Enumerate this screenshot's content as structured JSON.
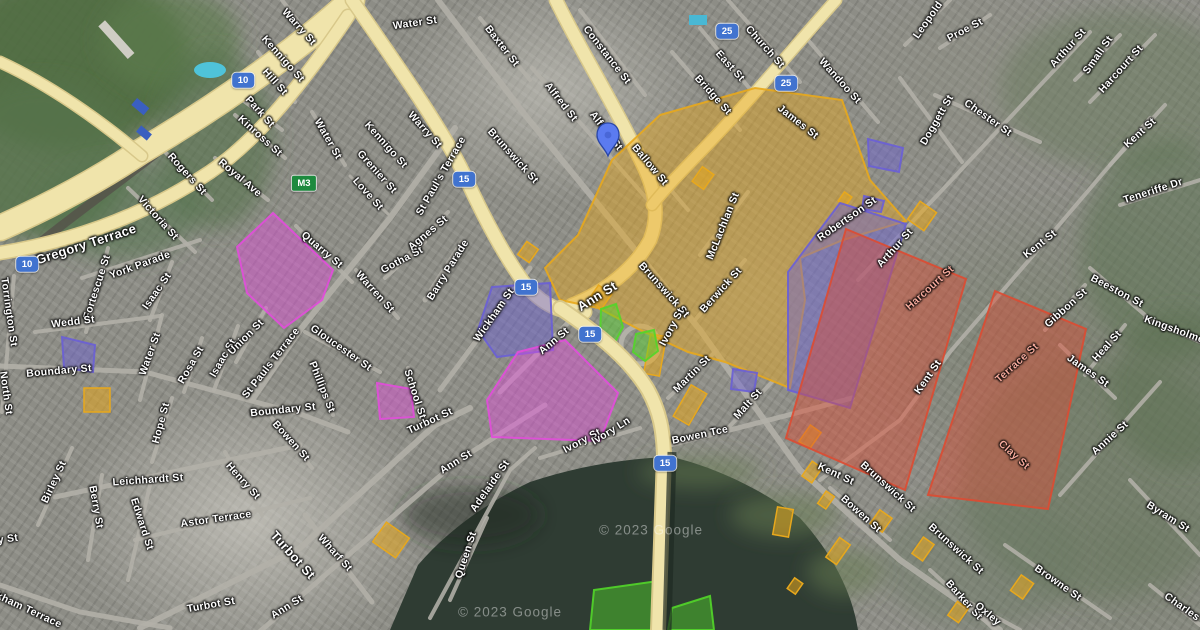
{
  "colors": {
    "zone_magenta": "#E24DDB",
    "zone_purple": "#6A5FD6",
    "zone_orange": "#E8A81C",
    "zone_red": "#DD4B32",
    "zone_green": "#52D629",
    "road_yellow": "#F0E4AB",
    "road_yellow_casing": "#D8C88A",
    "road_gray": "#B3B1A8",
    "water": "#2F3C33",
    "pin_blue": "#5B7BF0",
    "shield_blue": "#4173CF",
    "shield_green": "#1D8A3E"
  },
  "map": {
    "attribution": "© 2023 Google",
    "pin": {
      "x": 608,
      "y": 158
    },
    "shields": [
      {
        "label": "M3",
        "x": 304,
        "y": 183,
        "kind": "green"
      },
      {
        "label": "10",
        "x": 243,
        "y": 80,
        "kind": "blue"
      },
      {
        "label": "10",
        "x": 27,
        "y": 264,
        "kind": "blue"
      },
      {
        "label": "15",
        "x": 464,
        "y": 179,
        "kind": "blue"
      },
      {
        "label": "15",
        "x": 526,
        "y": 287,
        "kind": "blue"
      },
      {
        "label": "15",
        "x": 590,
        "y": 334,
        "kind": "blue"
      },
      {
        "label": "15",
        "x": 665,
        "y": 463,
        "kind": "blue"
      },
      {
        "label": "25",
        "x": 727,
        "y": 31,
        "kind": "blue"
      },
      {
        "label": "25",
        "x": 786,
        "y": 83,
        "kind": "blue"
      }
    ],
    "labels": [
      {
        "t": "Warry St",
        "x": 299,
        "y": 27,
        "r": 48
      },
      {
        "t": "Kennigo St",
        "x": 283,
        "y": 59,
        "r": 48
      },
      {
        "t": "Hill St",
        "x": 275,
        "y": 82,
        "r": 48
      },
      {
        "t": "Park St",
        "x": 260,
        "y": 112,
        "r": 48
      },
      {
        "t": "Kinross St",
        "x": 260,
        "y": 136,
        "r": 42
      },
      {
        "t": "Water St",
        "x": 328,
        "y": 139,
        "r": 60
      },
      {
        "t": "Rogers St",
        "x": 187,
        "y": 174,
        "r": 48
      },
      {
        "t": "Royal Ave",
        "x": 240,
        "y": 178,
        "r": 40
      },
      {
        "t": "Victoria St",
        "x": 158,
        "y": 218,
        "r": 48
      },
      {
        "t": "Gregory Terrace",
        "x": 86,
        "y": 244,
        "r": -18,
        "c": "lg"
      },
      {
        "t": "York Parade",
        "x": 140,
        "y": 265,
        "r": -20
      },
      {
        "t": "Fortescue St",
        "x": 97,
        "y": 287,
        "r": -72
      },
      {
        "t": "Isaac St",
        "x": 157,
        "y": 291,
        "r": -55
      },
      {
        "t": "Wedd St",
        "x": 73,
        "y": 322,
        "r": -7
      },
      {
        "t": "Torrington St",
        "x": 9,
        "y": 312,
        "r": 82
      },
      {
        "t": "North St",
        "x": 6,
        "y": 393,
        "r": 82
      },
      {
        "t": "Boundary St",
        "x": 59,
        "y": 371,
        "r": -5
      },
      {
        "t": "Water St",
        "x": 150,
        "y": 354,
        "r": -70
      },
      {
        "t": "Rosa St",
        "x": 191,
        "y": 365,
        "r": -60
      },
      {
        "t": "Isaac St",
        "x": 223,
        "y": 358,
        "r": -60
      },
      {
        "t": "Union St",
        "x": 246,
        "y": 337,
        "r": -45
      },
      {
        "t": "St Pauls Terrace",
        "x": 271,
        "y": 363,
        "r": -52
      },
      {
        "t": "Quarry St",
        "x": 322,
        "y": 250,
        "r": 40
      },
      {
        "t": "Warren St",
        "x": 375,
        "y": 292,
        "r": 48
      },
      {
        "t": "Gloucester St",
        "x": 341,
        "y": 348,
        "r": 35
      },
      {
        "t": "Phillips St",
        "x": 322,
        "y": 387,
        "r": 68
      },
      {
        "t": "Boundary St",
        "x": 283,
        "y": 410,
        "r": -6
      },
      {
        "t": "School St",
        "x": 415,
        "y": 394,
        "r": 72
      },
      {
        "t": "Kennigo St",
        "x": 386,
        "y": 145,
        "r": 48
      },
      {
        "t": "Grenier St",
        "x": 377,
        "y": 172,
        "r": 48
      },
      {
        "t": "Love St",
        "x": 368,
        "y": 194,
        "r": 48
      },
      {
        "t": "Warry St",
        "x": 425,
        "y": 130,
        "r": 48
      },
      {
        "t": "St Paul's Terrace",
        "x": 441,
        "y": 176,
        "r": -60
      },
      {
        "t": "Water St",
        "x": 415,
        "y": 23,
        "r": -8
      },
      {
        "t": "Baxter St",
        "x": 502,
        "y": 46,
        "r": 52
      },
      {
        "t": "Constance St",
        "x": 607,
        "y": 55,
        "r": 52
      },
      {
        "t": "Alfred St",
        "x": 561,
        "y": 102,
        "r": 52
      },
      {
        "t": "Alfred St",
        "x": 606,
        "y": 131,
        "r": 52
      },
      {
        "t": "Ballow St",
        "x": 650,
        "y": 165,
        "r": 50
      },
      {
        "t": "East St",
        "x": 730,
        "y": 66,
        "r": 48
      },
      {
        "t": "Bridge St",
        "x": 713,
        "y": 95,
        "r": 48
      },
      {
        "t": "Church St",
        "x": 765,
        "y": 47,
        "r": 48
      },
      {
        "t": "Wandoo St",
        "x": 840,
        "y": 81,
        "r": 48
      },
      {
        "t": "James St",
        "x": 798,
        "y": 122,
        "r": 38
      },
      {
        "t": "Leopold",
        "x": 928,
        "y": 20,
        "r": -55
      },
      {
        "t": "Proe St",
        "x": 965,
        "y": 30,
        "r": -28
      },
      {
        "t": "Arthur St",
        "x": 1068,
        "y": 48,
        "r": -48
      },
      {
        "t": "Small St",
        "x": 1098,
        "y": 55,
        "r": -55
      },
      {
        "t": "Harcourt St",
        "x": 1121,
        "y": 69,
        "r": -48
      },
      {
        "t": "Chester St",
        "x": 988,
        "y": 118,
        "r": 35
      },
      {
        "t": "Doggett St",
        "x": 937,
        "y": 120,
        "r": -60
      },
      {
        "t": "Kent St",
        "x": 1140,
        "y": 133,
        "r": -42
      },
      {
        "t": "Teneriffe Dr",
        "x": 1153,
        "y": 191,
        "r": -18
      },
      {
        "t": "Gotha St",
        "x": 402,
        "y": 260,
        "r": -28
      },
      {
        "t": "Agnes St",
        "x": 428,
        "y": 233,
        "r": -40
      },
      {
        "t": "Barry Parade",
        "x": 448,
        "y": 270,
        "r": -58
      },
      {
        "t": "Wickham St",
        "x": 494,
        "y": 315,
        "r": -55
      },
      {
        "t": "Ann St",
        "x": 554,
        "y": 341,
        "r": -40
      },
      {
        "t": "Ann St",
        "x": 597,
        "y": 296,
        "r": -32,
        "c": "lg"
      },
      {
        "t": "Brunswick St",
        "x": 513,
        "y": 156,
        "r": 48
      },
      {
        "t": "Brunswick St",
        "x": 664,
        "y": 290,
        "r": 48
      },
      {
        "t": "McLachlan St",
        "x": 723,
        "y": 226,
        "r": -68
      },
      {
        "t": "Berwick St",
        "x": 721,
        "y": 290,
        "r": -48
      },
      {
        "t": "Ivory St",
        "x": 672,
        "y": 327,
        "r": -62
      },
      {
        "t": "Martin St",
        "x": 692,
        "y": 374,
        "r": -45
      },
      {
        "t": "Malt St",
        "x": 748,
        "y": 404,
        "r": -48
      },
      {
        "t": "Ivory St",
        "x": 582,
        "y": 441,
        "r": -28
      },
      {
        "t": "Ivory Ln",
        "x": 611,
        "y": 431,
        "r": -32
      },
      {
        "t": "Bowen Tce",
        "x": 700,
        "y": 435,
        "r": -12
      },
      {
        "t": "Robertson St",
        "x": 847,
        "y": 219,
        "r": -35
      },
      {
        "t": "Arthur St",
        "x": 895,
        "y": 248,
        "r": -48
      },
      {
        "t": "Harcourt St",
        "x": 930,
        "y": 288,
        "r": -42,
        "c": "red"
      },
      {
        "t": "Terrace St",
        "x": 1017,
        "y": 363,
        "r": -42,
        "c": "red"
      },
      {
        "t": "Kent St",
        "x": 928,
        "y": 377,
        "r": -55
      },
      {
        "t": "Kent St",
        "x": 1040,
        "y": 244,
        "r": -38
      },
      {
        "t": "Gibbon St",
        "x": 1066,
        "y": 308,
        "r": -42
      },
      {
        "t": "Beeston St",
        "x": 1117,
        "y": 291,
        "r": 28
      },
      {
        "t": "Kingsholme St",
        "x": 1181,
        "y": 332,
        "r": 20
      },
      {
        "t": "Heal St",
        "x": 1107,
        "y": 346,
        "r": -48
      },
      {
        "t": "James St",
        "x": 1088,
        "y": 371,
        "r": 35
      },
      {
        "t": "Kent St",
        "x": 836,
        "y": 474,
        "r": 25
      },
      {
        "t": "Brunswick St",
        "x": 888,
        "y": 487,
        "r": 42
      },
      {
        "t": "Brunswick St",
        "x": 956,
        "y": 549,
        "r": 42
      },
      {
        "t": "Bowen St",
        "x": 861,
        "y": 514,
        "r": 42
      },
      {
        "t": "Barker St",
        "x": 964,
        "y": 600,
        "r": 48
      },
      {
        "t": "Oxley",
        "x": 988,
        "y": 614,
        "r": 40
      },
      {
        "t": "Browne St",
        "x": 1058,
        "y": 583,
        "r": 35
      },
      {
        "t": "Annie St",
        "x": 1110,
        "y": 438,
        "r": -42
      },
      {
        "t": "Byram St",
        "x": 1168,
        "y": 517,
        "r": 32
      },
      {
        "t": "Charles",
        "x": 1182,
        "y": 607,
        "r": 35
      },
      {
        "t": "Clay St",
        "x": 1014,
        "y": 455,
        "r": 42,
        "c": "red"
      },
      {
        "t": "Turbot St",
        "x": 430,
        "y": 421,
        "r": -25
      },
      {
        "t": "Turbot St",
        "x": 293,
        "y": 555,
        "r": 48,
        "c": "lg"
      },
      {
        "t": "Turbot St",
        "x": 211,
        "y": 605,
        "r": -10
      },
      {
        "t": "Astor Terrace",
        "x": 216,
        "y": 519,
        "r": -8
      },
      {
        "t": "Leichhardt St",
        "x": 148,
        "y": 480,
        "r": -4
      },
      {
        "t": "Henry St",
        "x": 243,
        "y": 481,
        "r": 48
      },
      {
        "t": "Edward St",
        "x": 142,
        "y": 524,
        "r": 72
      },
      {
        "t": "Berry St",
        "x": 96,
        "y": 507,
        "r": 80
      },
      {
        "t": "Birley St",
        "x": 54,
        "y": 482,
        "r": -65
      },
      {
        "t": "Hope St",
        "x": 161,
        "y": 423,
        "r": -75
      },
      {
        "t": "Bowen St",
        "x": 291,
        "y": 441,
        "r": 48
      },
      {
        "t": "Wharf St",
        "x": 335,
        "y": 553,
        "r": 48
      },
      {
        "t": "Ann St",
        "x": 456,
        "y": 462,
        "r": -32
      },
      {
        "t": "Adelaide St",
        "x": 490,
        "y": 486,
        "r": -55
      },
      {
        "t": "Queen St",
        "x": 466,
        "y": 555,
        "r": -72
      },
      {
        "t": "Ann St",
        "x": 287,
        "y": 607,
        "r": -32
      },
      {
        "t": "Wickham Terrace",
        "x": 20,
        "y": 606,
        "r": 25
      },
      {
        "t": "y St",
        "x": 8,
        "y": 539,
        "r": -8
      },
      {
        "t": "© 2023 Google",
        "x": 651,
        "y": 530,
        "r": 0,
        "c": "wm"
      },
      {
        "t": "© 2023 Google",
        "x": 510,
        "y": 612,
        "r": 0,
        "c": "wm"
      }
    ]
  }
}
